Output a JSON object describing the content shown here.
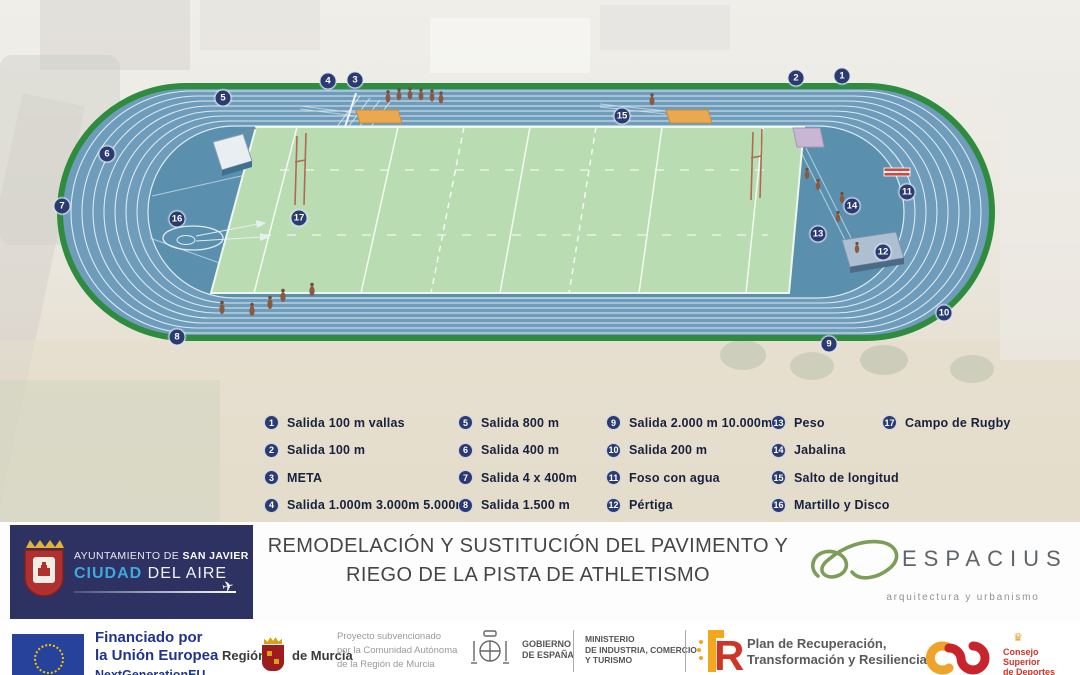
{
  "track": {
    "markers": [
      {
        "num": "1",
        "x": 842,
        "y": 76
      },
      {
        "num": "2",
        "x": 796,
        "y": 78
      },
      {
        "num": "3",
        "x": 355,
        "y": 80
      },
      {
        "num": "4",
        "x": 328,
        "y": 81
      },
      {
        "num": "5",
        "x": 223,
        "y": 98
      },
      {
        "num": "6",
        "x": 107,
        "y": 154
      },
      {
        "num": "7",
        "x": 62,
        "y": 206
      },
      {
        "num": "8",
        "x": 177,
        "y": 337
      },
      {
        "num": "9",
        "x": 829,
        "y": 344
      },
      {
        "num": "10",
        "x": 944,
        "y": 313
      },
      {
        "num": "11",
        "x": 907,
        "y": 192
      },
      {
        "num": "12",
        "x": 883,
        "y": 252
      },
      {
        "num": "13",
        "x": 818,
        "y": 234
      },
      {
        "num": "14",
        "x": 852,
        "y": 206
      },
      {
        "num": "15",
        "x": 622,
        "y": 116
      },
      {
        "num": "16",
        "x": 177,
        "y": 219
      },
      {
        "num": "17",
        "x": 299,
        "y": 218
      }
    ],
    "colors": {
      "track_blue": "#6f9cba",
      "infield_blue": "#5a8fae",
      "border_green": "#2f8c3e",
      "rugby_green": "#b9dcb3",
      "marker_navy": "#2b3a70",
      "pit_orange": "#eba94f"
    }
  },
  "legend": {
    "columns": [
      {
        "x": 264,
        "items": [
          {
            "num": "1",
            "label": "Salida 100 m vallas"
          },
          {
            "num": "2",
            "label": "Salida 100 m"
          },
          {
            "num": "3",
            "label": "META"
          },
          {
            "num": "4",
            "label": "Salida 1.000m 3.000m 5.000m"
          }
        ]
      },
      {
        "x": 458,
        "items": [
          {
            "num": "5",
            "label": "Salida 800 m"
          },
          {
            "num": "6",
            "label": "Salida 400 m"
          },
          {
            "num": "7",
            "label": "Salida 4 x 400m"
          },
          {
            "num": "8",
            "label": "Salida 1.500 m"
          }
        ]
      },
      {
        "x": 606,
        "items": [
          {
            "num": "9",
            "label": "Salida 2.000 m 10.000m"
          },
          {
            "num": "10",
            "label": "Salida 200 m"
          },
          {
            "num": "11",
            "label": "Foso con agua"
          },
          {
            "num": "12",
            "label": "Pértiga"
          }
        ]
      },
      {
        "x": 771,
        "items": [
          {
            "num": "13",
            "label": "Peso"
          },
          {
            "num": "14",
            "label": "Jabalina"
          },
          {
            "num": "15",
            "label": "Salto de longitud"
          },
          {
            "num": "16",
            "label": "Martillo y Disco"
          }
        ]
      },
      {
        "x": 882,
        "items": [
          {
            "num": "17",
            "label": "Campo de Rugby"
          }
        ]
      }
    ]
  },
  "footer": {
    "municipality": {
      "line1_normal": "AYUNTAMIENTO DE ",
      "line1_bold": "SAN JAVIER",
      "line2_blue": "CIUDAD",
      "line2_rest": " DEL AIRE"
    },
    "title_line1": "REMODELACIÓN Y SUSTITUCIÓN DEL PAVIMENTO Y",
    "title_line2": "RIEGO DE LA PISTA DE ATHLETISMO",
    "espacius": {
      "name": "ESPACIUS",
      "tagline": "arquitectura y urbanismo"
    }
  },
  "funding": {
    "eu": {
      "line1": "Financiado por",
      "line2": "la Unión Europea",
      "line3": "NextGenerationEU"
    },
    "murcia": {
      "left": "Región",
      "right": "de Murcia"
    },
    "subsidy": [
      "Proyecto subvencionado",
      "por la Comunidad Autónoma",
      "de la Región de Murcia"
    ],
    "gobierno": {
      "l1": "GOBIERNO",
      "l2": "DE ESPAÑA"
    },
    "ministerio": [
      "MINISTERIO",
      "DE INDUSTRIA, COMERCIO",
      "Y TURISMO"
    ],
    "plan": [
      "Plan de Recuperación,",
      "Transformación y Resiliencia"
    ],
    "csd": [
      "Consejo",
      "Superior",
      "de Deportes"
    ]
  },
  "icons": {
    "airplane": "✈",
    "crown": "♛"
  }
}
